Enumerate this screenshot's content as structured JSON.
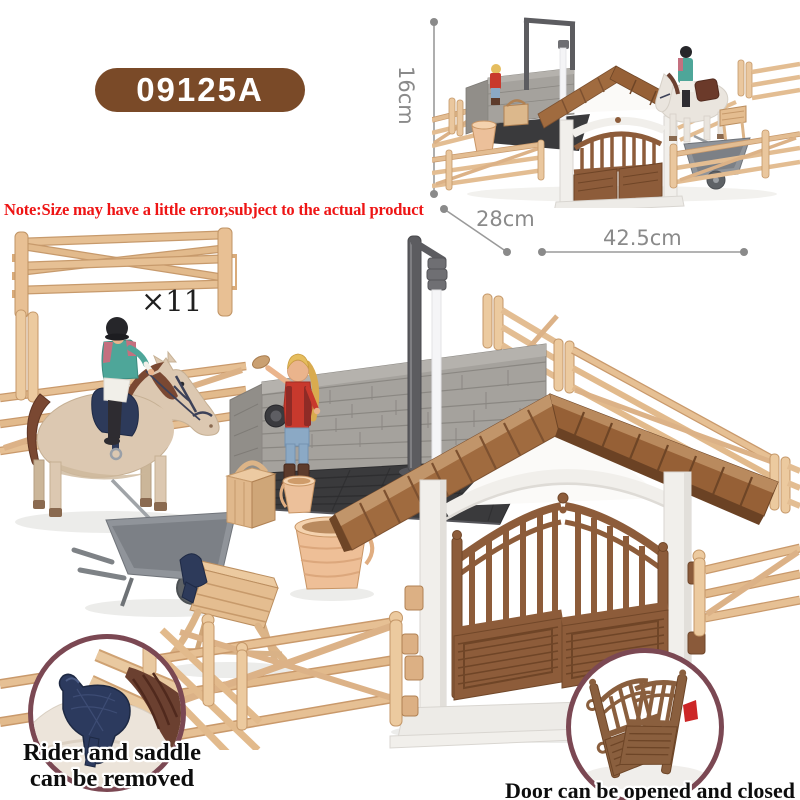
{
  "product": {
    "model_number": "09125A",
    "size_note": "Note:Size may have a little error,subject to the actual product",
    "fence_quantity_label": "×11",
    "dimensions": {
      "height_label": "16cm",
      "depth_label": "28cm",
      "width_label": "42.5cm"
    },
    "feature_captions": {
      "saddle_line1": "Rider and saddle",
      "saddle_line2": "can be removed",
      "door": "Door can be opened and closed"
    }
  },
  "scene": {
    "main_photo": "toy horse paddock playset with rider, wash station, buckets, wheelbarrow and stable gate",
    "thumbnail_photo": "assembled playset overview",
    "saddle_inset": "close-up of removable navy saddle on horse",
    "door_inset": "stable gate doors shown open"
  },
  "colors": {
    "badge_brown": "#7a4a28",
    "note_red": "#ee1515",
    "dimension_gray": "#8a8a8a",
    "fence_tan": "#e2bb8e",
    "roof_brown": "#a06b3f",
    "door_brown": "#8d5c3a",
    "wall_gray": "#a5a29d",
    "saddle_navy": "#2d3a5a",
    "inset_border_plum": "#7b4853"
  }
}
